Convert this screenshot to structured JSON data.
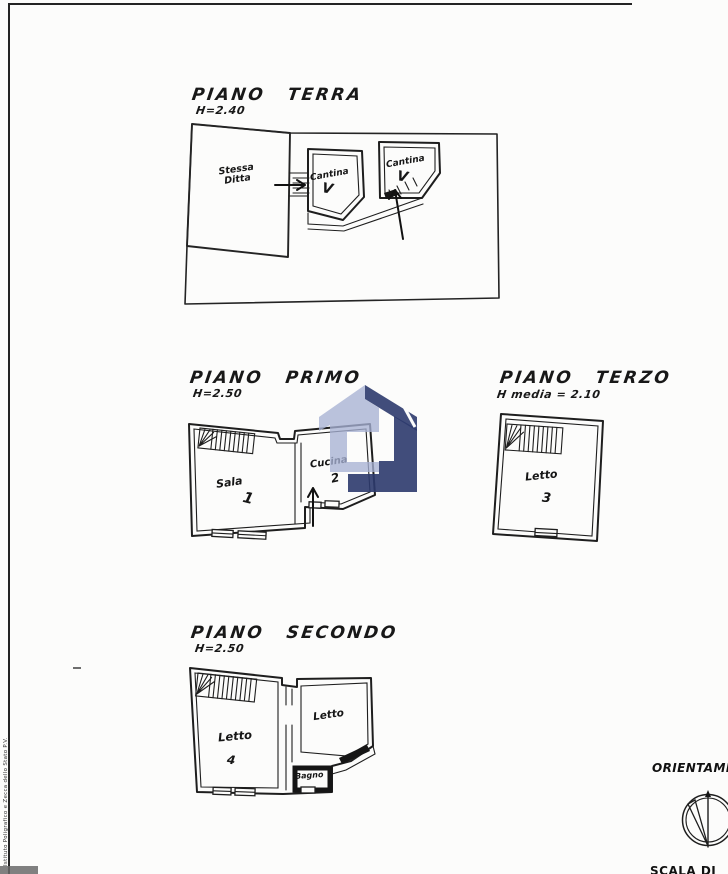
{
  "page": {
    "paper_color": "#fcfcfb",
    "ink_color": "#1e1e1e"
  },
  "floors": [
    {
      "title": "PIANO TERRA",
      "height_note": "H=2.40",
      "rooms": [
        {
          "label": "Stessa Ditta"
        },
        {
          "label": "Cantina",
          "mark": "V"
        },
        {
          "label": "Cantina",
          "mark": "V"
        }
      ]
    },
    {
      "title": "PIANO PRIMO",
      "height_note": "H=2.50",
      "rooms": [
        {
          "label": "Sala",
          "mark": "1"
        },
        {
          "label": "Cucina",
          "mark": "2"
        }
      ]
    },
    {
      "title": "PIANO TERZO",
      "height_note": "H media = 2.10",
      "rooms": [
        {
          "label": "Letto",
          "mark": "3"
        }
      ]
    },
    {
      "title": "PIANO SECONDO",
      "height_note": "H=2.50",
      "rooms": [
        {
          "label": "Letto",
          "mark": "4"
        },
        {
          "label": "Letto"
        },
        {
          "label": "Bagno"
        }
      ]
    }
  ],
  "annotations": {
    "orientation_label": "ORIENTAMENTO",
    "scale_label": "SCALA DI",
    "printer_credit": "Istituto Poligrafico e Zecca dello Stato   P.V."
  },
  "watermark": {
    "light_color": "#a7b1d3",
    "dark_color": "#2c3a6d"
  }
}
